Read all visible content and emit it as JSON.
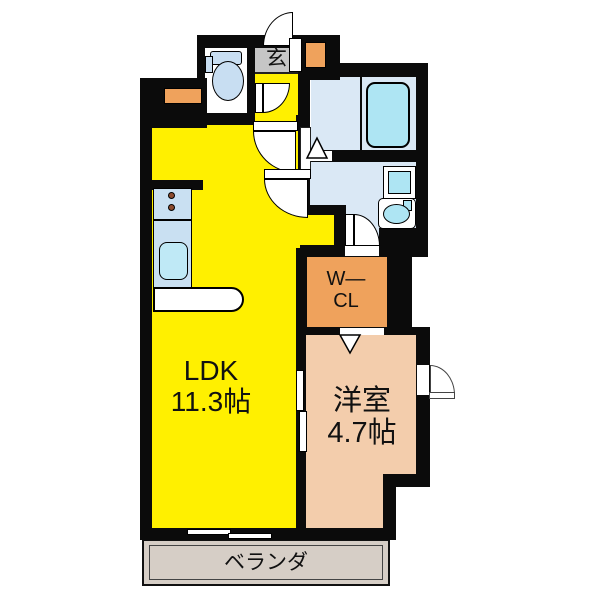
{
  "title": "apartment-floor-plan",
  "colors": {
    "wall": "#0b0b0b",
    "ldk": "#FFF000",
    "western": "#F3CDAC",
    "closet": "#EFA25C",
    "cabinet": "#EFA25C",
    "water": "#DAE8F5",
    "fixture": "#AEE5F3",
    "toilet": "#C8DEF2",
    "kitchen": "#C9E0F2",
    "sink": "#BFE9F6",
    "entrance_floor": "#C6C6C6",
    "veranda": "#D6CEC6",
    "stove": "#8C4B2E"
  },
  "rooms": {
    "ldk": {
      "line1": "LDK",
      "line2": "11.3帖"
    },
    "western": {
      "line1": "洋室",
      "line2": "4.7帖"
    },
    "closet": {
      "line1": "W―",
      "line2": "CL"
    },
    "entrance": {
      "label": "玄"
    },
    "veranda": {
      "label": "ベランダ"
    }
  }
}
